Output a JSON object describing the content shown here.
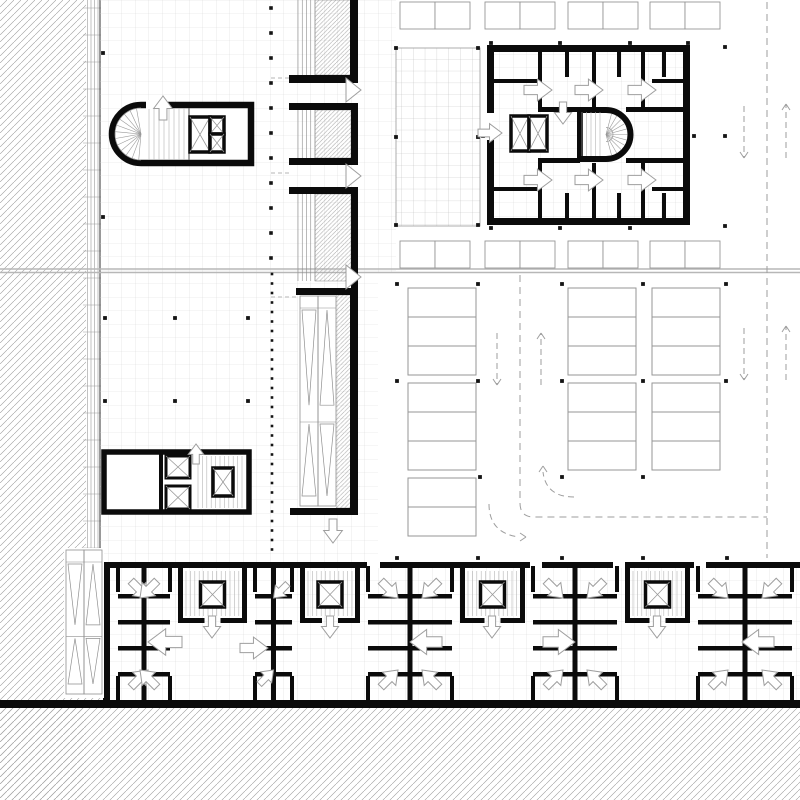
{
  "meta": {
    "drawing": "architectural-floor-plan",
    "level": "parking-and-core-plan"
  },
  "colors": {
    "wall": "#0b0b0b",
    "grid": "#d9d9d9",
    "gridDark": "#c0c0c0",
    "hatch": "#9b9b9b",
    "hatchDense": "#a3a3a3",
    "thin": "#8f8f8f",
    "tread": "#b4b4b4",
    "stall": "#969696",
    "dash": "#9e9e9e",
    "divider": "#b7b7b7",
    "arrow": "#9e9e9e",
    "dot": "#141414",
    "facade": "#9a9a9a",
    "white": "#ffffff"
  },
  "hatch_regions": [
    {
      "x": 0,
      "y": 0,
      "w": 86,
      "h": 800
    },
    {
      "x": 0,
      "y": 704,
      "w": 800,
      "h": 96
    },
    {
      "poly": "86,520 103,560 103,704 86,704"
    }
  ],
  "hatch_dense_regions": [
    {
      "x": 315,
      "y": 0,
      "w": 36,
      "h": 75
    },
    {
      "x": 315,
      "y": 110,
      "w": 36,
      "h": 48
    },
    {
      "x": 315,
      "y": 194,
      "w": 36,
      "h": 87
    },
    {
      "x": 336,
      "y": 295,
      "w": 15,
      "h": 213
    }
  ],
  "facade": {
    "bandX": 86,
    "bandW": 14,
    "y0": 0,
    "y1": 562,
    "lines": [
      87.5,
      91,
      94.5,
      98
    ],
    "wallX": 100,
    "tickStep": 27
  },
  "grid_regions": [
    {
      "x": 100,
      "y": 0,
      "w": 258,
      "h": 562,
      "dark": false
    },
    {
      "x": 358,
      "y": 0,
      "w": 38,
      "h": 272,
      "dark": false
    },
    {
      "x": 358,
      "y": 272,
      "w": 20,
      "h": 290,
      "dark": false
    },
    {
      "x": 396,
      "y": 48,
      "w": 84,
      "h": 178,
      "dark": true,
      "border": true
    },
    {
      "x": 492,
      "y": 50,
      "w": 193,
      "h": 170,
      "dark": false
    },
    {
      "x": 103,
      "y": 566,
      "w": 697,
      "h": 136,
      "dark": false
    }
  ],
  "divider": {
    "y1": 269,
    "y2": 272.5
  },
  "walls": [
    [
      289,
      75,
      69,
      8
    ],
    [
      350,
      0,
      8,
      83
    ],
    [
      289,
      103,
      69,
      7
    ],
    [
      351,
      103,
      7,
      62
    ],
    [
      289,
      158,
      69,
      7
    ],
    [
      289,
      187,
      69,
      7
    ],
    [
      351,
      187,
      7,
      101
    ],
    [
      296,
      288,
      60,
      7
    ],
    [
      350,
      288,
      8,
      227
    ],
    [
      290,
      508,
      66,
      7
    ],
    [
      100,
      562,
      700,
      6
    ],
    [
      0,
      700,
      800,
      8
    ],
    [
      103,
      562,
      7,
      141
    ],
    [
      487,
      45,
      203,
      7
    ],
    [
      487,
      218,
      203,
      7
    ],
    [
      683,
      52,
      7,
      166
    ],
    [
      487,
      52,
      7,
      61
    ],
    [
      487,
      140,
      7,
      78
    ],
    [
      538,
      107,
      42,
      5
    ],
    [
      626,
      107,
      64,
      5
    ],
    [
      538,
      158,
      42,
      5
    ],
    [
      626,
      158,
      64,
      5
    ],
    [
      538,
      52,
      4,
      55
    ],
    [
      565,
      52,
      4,
      25
    ],
    [
      592,
      52,
      4,
      55
    ],
    [
      617,
      52,
      4,
      25
    ],
    [
      641,
      52,
      4,
      55
    ],
    [
      662,
      52,
      4,
      25
    ],
    [
      490,
      79,
      48,
      4
    ],
    [
      652,
      79,
      31,
      4
    ],
    [
      538,
      163,
      4,
      55
    ],
    [
      565,
      193,
      4,
      25
    ],
    [
      592,
      163,
      4,
      55
    ],
    [
      617,
      193,
      4,
      25
    ],
    [
      641,
      163,
      4,
      55
    ],
    [
      662,
      193,
      4,
      25
    ],
    [
      490,
      187,
      48,
      4
    ],
    [
      652,
      187,
      31,
      4
    ]
  ],
  "wall_gaps": [
    [
      367,
      562,
      13,
      6
    ],
    [
      530,
      562,
      12,
      6
    ],
    [
      613,
      562,
      12,
      6
    ],
    [
      694,
      562,
      12,
      6
    ]
  ],
  "strip_panels": [
    {
      "x": 298,
      "w": 17,
      "y0": 0,
      "y1": 75
    },
    {
      "x": 298,
      "w": 17,
      "y0": 110,
      "y1": 158
    },
    {
      "x": 298,
      "w": 17,
      "y0": 194,
      "y1": 281
    }
  ],
  "chevrons": [
    [
      346,
      90
    ],
    [
      346,
      176
    ],
    [
      346,
      277
    ]
  ],
  "escalators": [
    {
      "white": [
        298,
        295,
        38,
        213
      ],
      "x": 300,
      "y": 296,
      "laneW": 18,
      "h": 210
    },
    {
      "white": [
        64,
        548,
        40,
        150
      ],
      "x": 66,
      "y": 550,
      "laneW": 18,
      "h": 144
    }
  ],
  "core_tl": {
    "cx": 141,
    "cy": 134,
    "r": 29,
    "right": 251,
    "top": 105,
    "bot": 163,
    "fanR": 26,
    "gap": [
      146,
      100,
      22,
      9
    ],
    "treads": {
      "x0": 149,
      "x1": 186,
      "y0": 108,
      "y1": 160
    },
    "landingX": 189,
    "elev": [
      [
        190,
        117,
        20,
        35
      ],
      [
        210,
        117,
        14,
        17
      ],
      [
        210,
        134,
        14,
        18
      ]
    ]
  },
  "cluster_ml": {
    "outer": [
      104,
      452,
      145,
      60
    ],
    "div": [
      159,
      452,
      4,
      60
    ],
    "shafts": [
      [
        166,
        456,
        24,
        22
      ],
      [
        166,
        486,
        24,
        23
      ]
    ],
    "treads": {
      "x0": 198,
      "x1": 244,
      "y0": 456,
      "y1": 508
    },
    "elev": [
      [
        213,
        468,
        20,
        28
      ]
    ]
  },
  "block_stair": {
    "cx": 606,
    "cy": 134.5,
    "r": 24.5,
    "left": 580,
    "top": 110,
    "bot": 159,
    "treads": {
      "x0": 582,
      "x1": 602,
      "y0": 112,
      "y1": 156
    }
  },
  "block_elev": [
    [
      511,
      116,
      18,
      35
    ],
    [
      529,
      116,
      18,
      35
    ]
  ],
  "bottom_cores": [
    [
      178,
      247
    ],
    [
      300,
      360
    ],
    [
      460,
      525
    ],
    [
      625,
      690
    ]
  ],
  "bottom_clusters": [
    [
      110,
      178
    ],
    [
      247,
      300
    ],
    [
      360,
      460
    ],
    [
      525,
      625
    ],
    [
      690,
      800
    ]
  ],
  "stalls": {
    "pairCell": [
      35,
      27
    ],
    "pair_rows": [
      {
        "y": 2,
        "xs": [
          400,
          485,
          568,
          650
        ]
      },
      {
        "y": 241,
        "xs": [
          400,
          485,
          568,
          650
        ]
      }
    ],
    "groupCell": [
      68,
      29
    ],
    "groups": [
      [
        408,
        288,
        3
      ],
      [
        408,
        383,
        3
      ],
      [
        408,
        478,
        2
      ],
      [
        568,
        288,
        3
      ],
      [
        568,
        383,
        3
      ],
      [
        652,
        288,
        3
      ],
      [
        652,
        383,
        3
      ]
    ]
  },
  "dots": {
    "runs": [
      {
        "x": 271,
        "y0": 8,
        "step": 25,
        "n": 11,
        "s": 3.6
      },
      {
        "x": 272,
        "y0": 274,
        "step": 9.5,
        "n": 30,
        "s": 2.6
      }
    ],
    "pts": [
      [
        105,
        318
      ],
      [
        175,
        318
      ],
      [
        248,
        318
      ],
      [
        105,
        401
      ],
      [
        175,
        401
      ],
      [
        248,
        401
      ],
      [
        103,
        53
      ],
      [
        103,
        217
      ],
      [
        396,
        48
      ],
      [
        478,
        48
      ],
      [
        396,
        137
      ],
      [
        478,
        137
      ],
      [
        396,
        225
      ],
      [
        478,
        225
      ],
      [
        491,
        43
      ],
      [
        560,
        43
      ],
      [
        630,
        43
      ],
      [
        688,
        43
      ],
      [
        725,
        47
      ],
      [
        483,
        136
      ],
      [
        694,
        136
      ],
      [
        725,
        136
      ],
      [
        491,
        228
      ],
      [
        560,
        228
      ],
      [
        630,
        228
      ],
      [
        725,
        226
      ],
      [
        397,
        284
      ],
      [
        478,
        284
      ],
      [
        562,
        284
      ],
      [
        643,
        284
      ],
      [
        726,
        284
      ],
      [
        397,
        381
      ],
      [
        478,
        381
      ],
      [
        562,
        381
      ],
      [
        643,
        381
      ],
      [
        726,
        381
      ],
      [
        480,
        477
      ],
      [
        562,
        477
      ],
      [
        643,
        477
      ],
      [
        397,
        558
      ],
      [
        478,
        558
      ],
      [
        562,
        558
      ],
      [
        643,
        558
      ],
      [
        727,
        558
      ]
    ]
  },
  "dashes": {
    "lines": [
      [
        767,
        2,
        767,
        558
      ],
      [
        520,
        275,
        520,
        503
      ]
    ],
    "paths": [
      "M520,503 Q520,517 534,517 L767,517"
    ],
    "stubs": [
      [
        271,
        78,
        291,
        78
      ],
      [
        271,
        173,
        291,
        173
      ],
      [
        271,
        297,
        296,
        297
      ]
    ],
    "arrows": [
      [
        497,
        333,
        497,
        385
      ],
      [
        541,
        385,
        541,
        333
      ],
      [
        744,
        106,
        744,
        158
      ],
      [
        786,
        158,
        786,
        104
      ],
      [
        744,
        328,
        744,
        380
      ],
      [
        786,
        380,
        786,
        326
      ]
    ],
    "turns": [
      {
        "d": "M574,497 Q546,497 543,472",
        "tip": [
          543,
          466
        ],
        "dir": "up"
      },
      {
        "d": "M489,504 Q489,533 519,537",
        "tip": [
          526,
          537
        ],
        "dir": "right"
      }
    ]
  },
  "door_arrows": [
    [
      163,
      96,
      "up",
      24
    ],
    [
      196,
      444,
      "up",
      20
    ],
    [
      333,
      543,
      "down",
      24
    ],
    [
      552,
      90,
      "right",
      28
    ],
    [
      603,
      90,
      "right",
      28
    ],
    [
      656,
      90,
      "right",
      28
    ],
    [
      552,
      180,
      "right",
      28
    ],
    [
      603,
      180,
      "right",
      28
    ],
    [
      656,
      180,
      "right",
      28
    ],
    [
      502,
      133,
      "right",
      24
    ],
    [
      563,
      124,
      "down",
      22
    ],
    [
      212,
      638,
      "down",
      22
    ],
    [
      330,
      638,
      "down",
      22
    ],
    [
      492,
      638,
      "down",
      22
    ],
    [
      657,
      638,
      "down",
      22
    ],
    [
      148,
      642,
      "left",
      34
    ],
    [
      268,
      648,
      "right",
      28
    ],
    [
      410,
      642,
      "left",
      32
    ],
    [
      575,
      642,
      "right",
      32
    ],
    [
      742,
      642,
      "left",
      32
    ]
  ]
}
